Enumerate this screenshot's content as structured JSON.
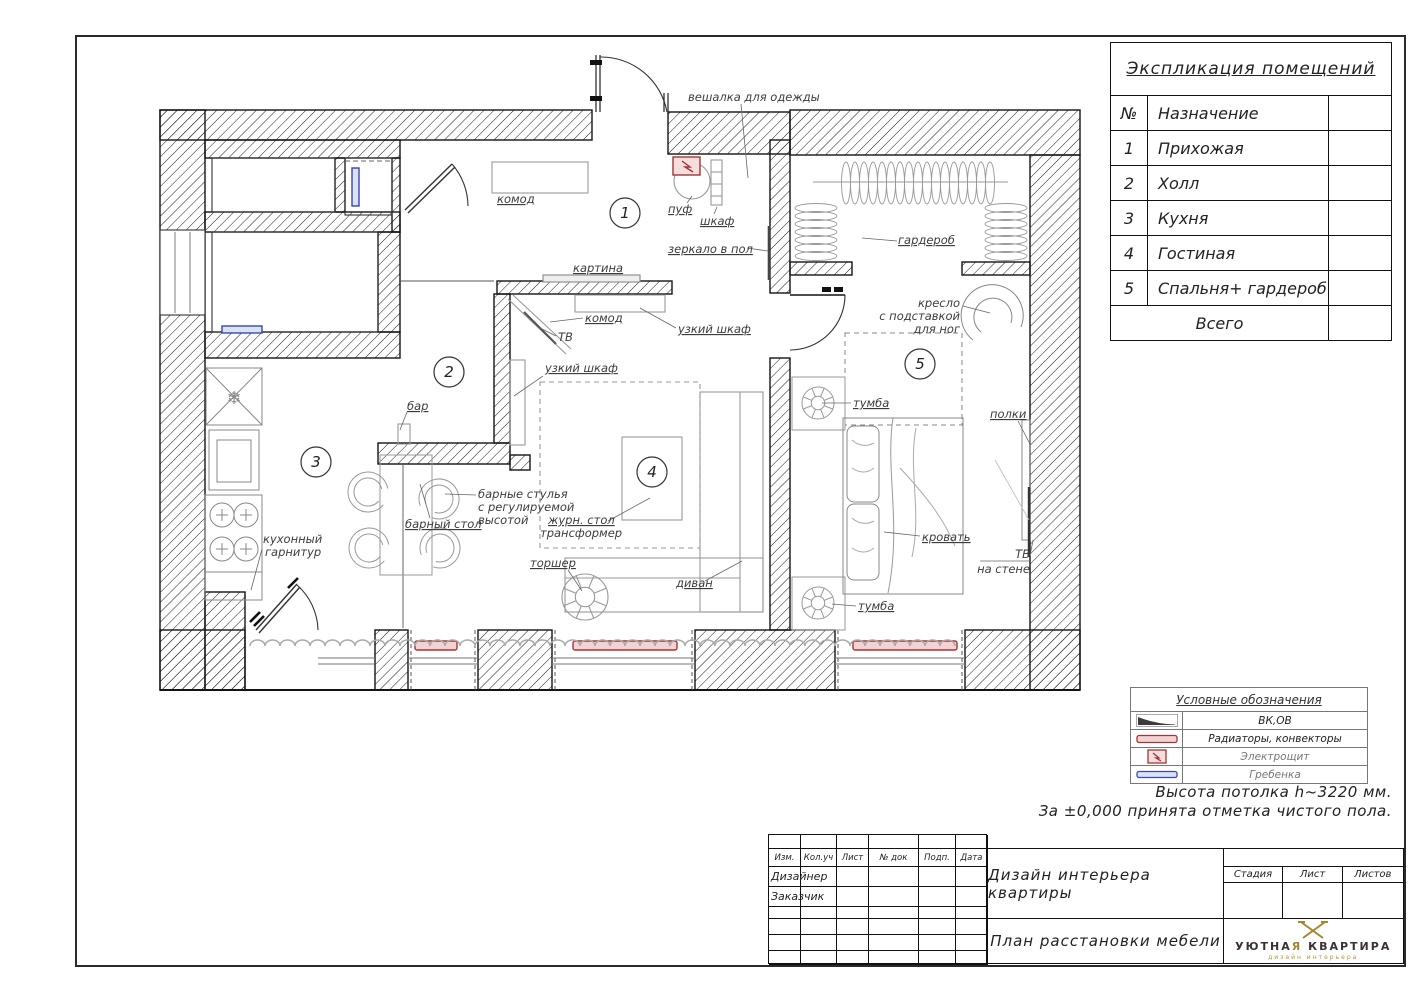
{
  "explication": {
    "title": "Экспликация помещений",
    "col_no": "№",
    "col_name": "Назначение",
    "rows": [
      {
        "no": "1",
        "name": "Прихожая"
      },
      {
        "no": "2",
        "name": "Холл"
      },
      {
        "no": "3",
        "name": "Кухня"
      },
      {
        "no": "4",
        "name": "Гостиная"
      },
      {
        "no": "5",
        "name": "Спальня+ гардероб"
      }
    ],
    "total": "Всего"
  },
  "legend": {
    "title": "Условные обозначения",
    "rows": [
      {
        "label": "ВК,ОВ",
        "symbol": "vent-wedge-icon",
        "tone": "dark"
      },
      {
        "label": "Радиаторы, конвекторы",
        "symbol": "radiator-icon",
        "tone": "dark"
      },
      {
        "label": "Электрощит",
        "symbol": "electro-panel-icon",
        "tone": "gray"
      },
      {
        "label": "Гребенка",
        "symbol": "comb-icon",
        "tone": "gray"
      }
    ]
  },
  "notes": {
    "line1": "Высота потолка h~3220 мм.",
    "line2": "За ±0,000 принята отметка чистого    пола."
  },
  "titleblock": {
    "cols": [
      "Изм.",
      "Кол.уч",
      "Лист",
      "№ док",
      "Подп.",
      "Дата"
    ],
    "designer": "Дизайнер",
    "customer": "Заказчик",
    "project": "Дизайн интерьера квартиры",
    "doc": "План расстановки мебели",
    "stage": "Стадия",
    "sheet": "Лист",
    "sheets": "Листов",
    "logo": {
      "name_a": "УЮТНА",
      "name_b": "Я",
      "name_c": " КВАРТИРА",
      "sub": "дизайн интерьера"
    }
  },
  "plan": {
    "rooms": {
      "r1": "1",
      "r2": "2",
      "r3": "3",
      "r4": "4",
      "r5": "5"
    },
    "snowflake": "❄",
    "labels": {
      "veshalka": "вешалка для одежды",
      "komod1": "комод",
      "puf": "пуф",
      "shkaf": "шкаф",
      "zerkalo": "зеркало в пол",
      "kartina": "картина",
      "komod2": "комод",
      "tv": "ТВ",
      "uzkiy1": "узкий шкаф",
      "uzkiy2": "узкий шкаф",
      "bar": "бар",
      "garderob": "гардероб",
      "kreslo1": "кресло",
      "kreslo2": "с подставкой",
      "kreslo3": "для ног",
      "tumba1": "тумба",
      "tumba2": "тумба",
      "polki": "полки",
      "stulya1": "барные стулья",
      "stulya2": "с регулируемой",
      "stulya3": "высотой",
      "zhurn1": "журн. стол",
      "zhurn2": "трансформер",
      "barstol": "барный стол",
      "kuh1": "кухонный",
      "kuh2": "гарнитур",
      "torsher": "торшер",
      "krovat": "кровать",
      "tvwall1": "ТВ",
      "tvwall2": "на стене",
      "divan": "диван"
    }
  },
  "colors": {
    "red": "#a23535",
    "red_fill": "#f2d3d3",
    "blue": "#3946b5",
    "blue_fill": "#dbe2f5",
    "gold": "#a8862e",
    "ink": "#141414"
  }
}
